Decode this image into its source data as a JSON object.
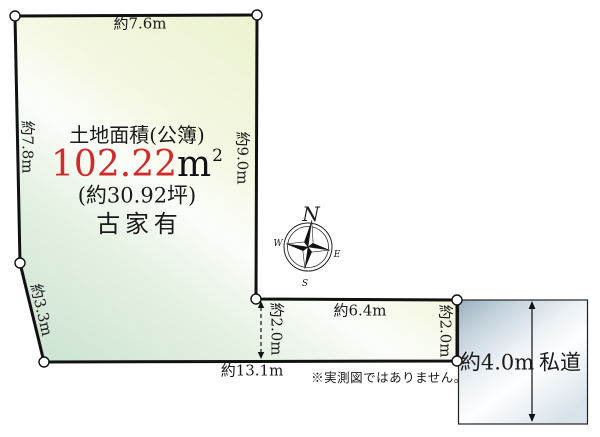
{
  "parcel": {
    "area_label": "土地面積(公簿)",
    "area_value": "102.22",
    "area_unit": "m",
    "area_unit_exp": "2",
    "tsubo_label": "(約30.92坪)",
    "building_label": "古家有"
  },
  "dimensions": {
    "top": "約7.6m",
    "left": "約7.8m",
    "right": "約9.0m",
    "slant": "約3.3m",
    "bottom": "約13.1m",
    "strip_top": "約6.4m",
    "strip_inner_width": "約2.0m",
    "strip_right_width": "約2.0m",
    "road_width": "約4.0m"
  },
  "road": {
    "label": "私道"
  },
  "compass": {
    "north": "N",
    "east": "E",
    "south": "S",
    "west": "W"
  },
  "note": "※実測図ではありません。",
  "colors": {
    "area_value_red": "#cf2b2b",
    "land_green": "#cbe1d0",
    "land_yellow": "#ebf1cf",
    "road_blue": "#9db0bd",
    "outline": "#111111"
  }
}
